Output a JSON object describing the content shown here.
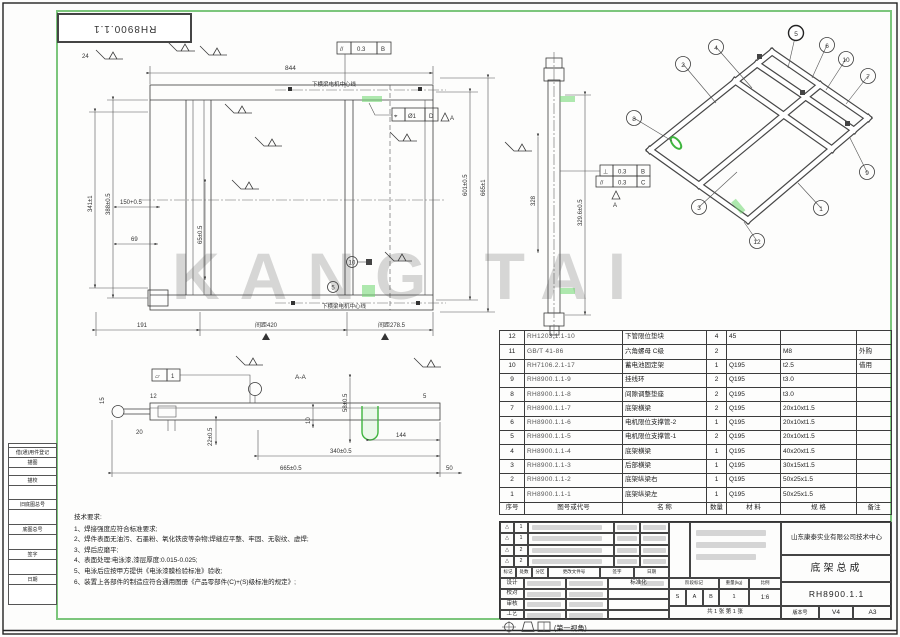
{
  "sheet": {
    "corner_code": "RH8900.1.1",
    "watermark": "KANG TAI",
    "projection_label": "(第一视角)"
  },
  "edge_fields": [
    "借(通)用件登记",
    "描图",
    "描校",
    "旧底图总号",
    "底图总号",
    "签字",
    "日期"
  ],
  "main_view": {
    "centerline_note_top": "下横梁电机中心线",
    "centerline_note_bottom": "下横梁电机中心线",
    "dim_top": "844",
    "dim_right_inner": "601±0.5",
    "dim_right_outer": "665±1",
    "dim_left_outer": "341±1",
    "dim_left_inner": "388±0.5",
    "dim_150": "150+0.5",
    "dim_69": "69",
    "dim_65": "65±0.5",
    "weld_note": "24",
    "dim_bottom_left": "191",
    "dim_bottom_mid": "间距420",
    "dim_bottom_right": "间距278.5",
    "balloon_5": "5",
    "balloon_10": "10",
    "fcf_parallel": {
      "sym": "//",
      "tol": "0.3",
      "datum": "B"
    },
    "fcf_position": {
      "sym": "⌖",
      "tol": "Ø1",
      "datum": "D",
      "ref": "A"
    }
  },
  "side_view": {
    "dim_inner": "328",
    "dim_outer": "329.6±0.5",
    "fcf_perp": {
      "sym": "⊥",
      "tol": "0.3",
      "datum": "B"
    },
    "fcf_par": {
      "sym": "//",
      "tol": "0.3",
      "datum": "C"
    },
    "datum_label": "A"
  },
  "detail_view": {
    "section_label": "A-A",
    "fcf_flat": {
      "sym": "▱",
      "tol": "1"
    },
    "dim_len": "665±0.5",
    "dim_mid": "340±0.5",
    "dim_slot": "144",
    "dim_50": "50",
    "dim_58": "58±0.5",
    "dim_22": "22±0.5",
    "dim_10": "10",
    "dim_12": "12",
    "dim_15": "15",
    "dim_20": "20",
    "dim_5": "5"
  },
  "iso_view": {
    "balloons": [
      "2",
      "4",
      "5",
      "6",
      "10",
      "7",
      "8",
      "9",
      "3",
      "1",
      "12"
    ]
  },
  "tech_notes": {
    "title": "技术要求:",
    "items": [
      "1、焊接强度应符合标准要求;",
      "2、焊件表面无油污、石墨粉、氧化铁皮等杂物;焊缝应平整、牢固、无裂纹、虚焊;",
      "3、焊后应磨平;",
      "4、表面处理:电泳漆,漆层厚度:0.015-0.025;",
      "5、电泳后应按甲方提供《电泳漆膜检验标准》验收;",
      "6、装置上各部件的制造应符合通用图册《产品零部件(C)+(S)级标准的规定》;"
    ]
  },
  "parts_table": {
    "headers": [
      "序号",
      "图号或代号",
      "名  称",
      "数量",
      "材  料",
      "规  格",
      "备注"
    ],
    "rows": [
      {
        "no": "12",
        "code": "RH1203.1.1-10",
        "name": "下管限位垫块",
        "qty": "4",
        "material": "45",
        "spec": "",
        "remark": ""
      },
      {
        "no": "11",
        "code": "GB/T 41-86",
        "name": "六角螺母 C级",
        "qty": "2",
        "material": "",
        "spec": "M8",
        "remark": "外购"
      },
      {
        "no": "10",
        "code": "RH7106.2.1-17",
        "name": "蓄电池固定架",
        "qty": "1",
        "material": "Q195",
        "spec": "t2.5",
        "remark": "借用"
      },
      {
        "no": "9",
        "code": "RH8900.1.1-9",
        "name": "挂线环",
        "qty": "2",
        "material": "Q195",
        "spec": "t3.0",
        "remark": ""
      },
      {
        "no": "8",
        "code": "RH8900.1.1-8",
        "name": "间隙调整垫座",
        "qty": "2",
        "material": "Q195",
        "spec": "t3.0",
        "remark": ""
      },
      {
        "no": "7",
        "code": "RH8900.1.1-7",
        "name": "底架横梁",
        "qty": "2",
        "material": "Q195",
        "spec": "20x10xt1.5",
        "remark": ""
      },
      {
        "no": "6",
        "code": "RH8900.1.1-6",
        "name": "电机限位支撑管-2",
        "qty": "1",
        "material": "Q195",
        "spec": "20x10xt1.5",
        "remark": ""
      },
      {
        "no": "5",
        "code": "RH8900.1.1-5",
        "name": "电机限位支撑管-1",
        "qty": "2",
        "material": "Q195",
        "spec": "20x10xt1.5",
        "remark": ""
      },
      {
        "no": "4",
        "code": "RH8900.1.1-4",
        "name": "底架横梁",
        "qty": "1",
        "material": "Q195",
        "spec": "40x20xt1.5",
        "remark": ""
      },
      {
        "no": "3",
        "code": "RH8900.1.1-3",
        "name": "后部横梁",
        "qty": "1",
        "material": "Q195",
        "spec": "30x15xt1.5",
        "remark": ""
      },
      {
        "no": "2",
        "code": "RH8900.1.1-2",
        "name": "底架纵梁右",
        "qty": "1",
        "material": "Q195",
        "spec": "50x25x1.5",
        "remark": ""
      },
      {
        "no": "1",
        "code": "RH8900.1.1-1",
        "name": "底架纵梁左",
        "qty": "1",
        "material": "Q195",
        "spec": "50x25x1.5",
        "remark": ""
      }
    ]
  },
  "title_block": {
    "company": "山东康泰实业有限公司技术中心",
    "product_name": "底架总成",
    "drawing_no": "RH8900.1.1",
    "rev_header": [
      "标记",
      "处数",
      "分区",
      "更改文件号",
      "签字",
      "日期"
    ],
    "rev_rows": [
      {
        "mark": "△",
        "count": "1"
      },
      {
        "mark": "△",
        "count": "1"
      },
      {
        "mark": "△",
        "count": "2"
      },
      {
        "mark": "△",
        "count": "2"
      }
    ],
    "sign_rows": [
      {
        "label": "设计",
        "label2": "标准化"
      },
      {
        "label": "校对",
        "label2": ""
      },
      {
        "label": "审核",
        "label2": ""
      },
      {
        "label": "工艺",
        "label2": ""
      }
    ],
    "stage_label": "阶段标记",
    "weight_label": "重量(kg)",
    "scale_label": "比例",
    "stage": [
      "S",
      "A",
      "B"
    ],
    "weight": "1",
    "scale": "1:6",
    "sheet_note": "共 1 张  第 1 张",
    "version_label": "版本号",
    "version": "V4",
    "paper": "A3"
  }
}
